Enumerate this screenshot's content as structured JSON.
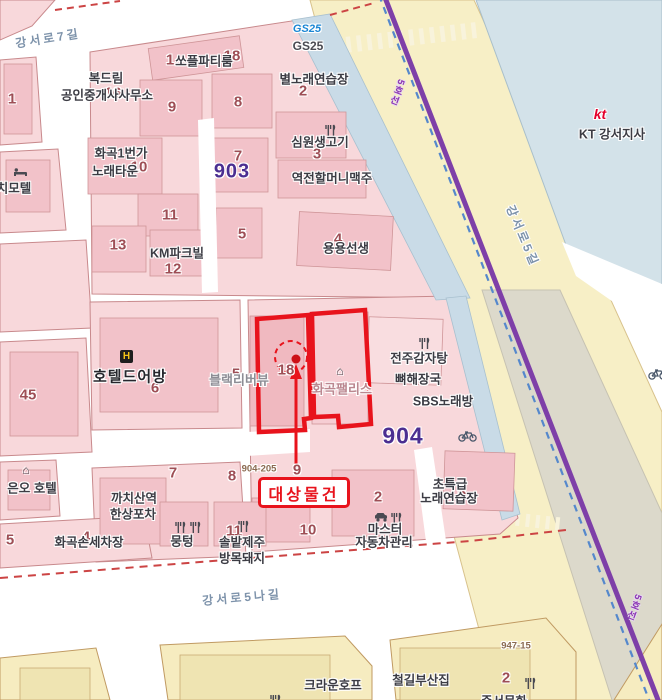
{
  "target": {
    "label": "대상물건",
    "number": "18"
  },
  "colors": {
    "target_red": "#e8131c",
    "red_dash": "#cc4444",
    "subway_purple": "#7e3fa8",
    "rail_blue_dash": "#5588cc",
    "district_purple": "#4b2e91",
    "block_pink": "#f8d8db",
    "building_pink": "#f2c2c9",
    "road_yellow": "#f7efc6",
    "kt_block_blue": "#d3e2e9",
    "sidewalk_blue": "#c9dbe7",
    "median_gray": "#dcd9cb",
    "bottom_block_yellow": "#f6ecc0"
  },
  "streets": [
    {
      "name": "street-gangseoro-7gil",
      "text": "강서로7길",
      "x": 48,
      "y": 38,
      "rot": -9
    },
    {
      "name": "street-gangseoro-5nagil",
      "text": "강서로5나길",
      "x": 242,
      "y": 597,
      "rot": -5
    },
    {
      "name": "street-gangseoro-5gil",
      "text": "강서로5길",
      "x": 523,
      "y": 236,
      "rot": 67
    }
  ],
  "subway_labels": [
    {
      "name": "subway-line5-label",
      "text": "5호선",
      "x": 396,
      "y": 92,
      "rot": 21
    },
    {
      "name": "subway-line5-label",
      "text": "5호선",
      "x": 633,
      "y": 607,
      "rot": 21
    }
  ],
  "district_numbers": [
    {
      "name": "block-number-903",
      "text": "903",
      "x": 232,
      "y": 172,
      "size": 20
    },
    {
      "name": "block-number-904",
      "text": "904",
      "x": 403,
      "y": 436,
      "size": 23
    }
  ],
  "building_numbers": [
    {
      "text": "1",
      "x": 12,
      "y": 99
    },
    {
      "text": "16",
      "x": 113,
      "y": 93
    },
    {
      "text": "1",
      "x": 170,
      "y": 60
    },
    {
      "text": "18",
      "x": 232,
      "y": 56
    },
    {
      "text": "9",
      "x": 172,
      "y": 107
    },
    {
      "text": "8",
      "x": 238,
      "y": 102
    },
    {
      "text": "2",
      "x": 303,
      "y": 91
    },
    {
      "text": "3",
      "x": 317,
      "y": 154
    },
    {
      "text": "7",
      "x": 238,
      "y": 156
    },
    {
      "text": "10",
      "x": 139,
      "y": 167
    },
    {
      "text": "11",
      "x": 170,
      "y": 215
    },
    {
      "text": "13",
      "x": 118,
      "y": 245
    },
    {
      "text": "12",
      "x": 173,
      "y": 269
    },
    {
      "text": "5",
      "x": 242,
      "y": 234
    },
    {
      "text": "4",
      "x": 338,
      "y": 239
    },
    {
      "text": "45",
      "x": 28,
      "y": 395
    },
    {
      "text": "6",
      "x": 155,
      "y": 388
    },
    {
      "text": "5",
      "x": 236,
      "y": 374
    },
    {
      "text": "18",
      "x": 286,
      "y": 370
    },
    {
      "text": "7",
      "x": 173,
      "y": 473
    },
    {
      "text": "8",
      "x": 232,
      "y": 476
    },
    {
      "text": "9",
      "x": 297,
      "y": 470
    },
    {
      "text": "10",
      "x": 308,
      "y": 530
    },
    {
      "text": "2",
      "x": 378,
      "y": 497
    },
    {
      "text": "6",
      "x": 462,
      "y": 493
    },
    {
      "text": "11",
      "x": 234,
      "y": 531
    },
    {
      "text": "2",
      "x": 506,
      "y": 678
    },
    {
      "text": "5",
      "x": 10,
      "y": 540
    },
    {
      "text": "4",
      "x": 86,
      "y": 537
    }
  ],
  "labels": [
    {
      "name": "label-bokdream",
      "text": "복드림",
      "x": 106,
      "y": 77,
      "cls": "lbl"
    },
    {
      "name": "label-realty-office",
      "text": "공인중개사사무소",
      "x": 107,
      "y": 94,
      "cls": "lbl"
    },
    {
      "name": "label-soplparty",
      "text": "쏘플파티룸",
      "x": 204,
      "y": 60,
      "cls": "lbl"
    },
    {
      "name": "label-byeol-karaoke",
      "text": "별노래연습장",
      "x": 314,
      "y": 78,
      "cls": "lbl"
    },
    {
      "name": "label-gs25-logo",
      "text": "GS25",
      "x": 307,
      "y": 29,
      "cls": "gs-logo"
    },
    {
      "name": "label-gs25",
      "text": "GS25",
      "x": 308,
      "y": 46,
      "cls": "gs-sub"
    },
    {
      "name": "label-simwon-meat",
      "text": "심원생고기",
      "x": 320,
      "y": 141,
      "cls": "lbl"
    },
    {
      "name": "label-yeokjeon-beer",
      "text": "역전할머니맥주",
      "x": 332,
      "y": 177,
      "cls": "lbl"
    },
    {
      "name": "label-hwagok1beonga",
      "text": "화곡1번가",
      "x": 121,
      "y": 152,
      "cls": "lbl"
    },
    {
      "name": "label-noraetown",
      "text": "노래타운",
      "x": 115,
      "y": 170,
      "cls": "lbl"
    },
    {
      "name": "label-km-parkville",
      "text": "KM파크빌",
      "x": 177,
      "y": 252,
      "cls": "lbl"
    },
    {
      "name": "label-yongyong",
      "text": "용용선생",
      "x": 346,
      "y": 247,
      "cls": "lbl"
    },
    {
      "name": "label-motel",
      "text": "치모텔",
      "x": 14,
      "y": 187,
      "cls": "lbl"
    },
    {
      "name": "label-hotel-deoban",
      "text": "호텔드어방",
      "x": 130,
      "y": 376,
      "cls": "lbl-lg"
    },
    {
      "name": "label-black-riverview",
      "text": "블랙리버뷰",
      "x": 239,
      "y": 379,
      "cls": "lbl-gray"
    },
    {
      "name": "label-hwagok-palace",
      "text": "화곡팰리스",
      "x": 342,
      "y": 388,
      "cls": "lbl-pink"
    },
    {
      "name": "label-jeonju-gamjatang",
      "text": "전주감자탕",
      "x": 419,
      "y": 357,
      "cls": "lbl"
    },
    {
      "name": "label-ppyeohaejangguk",
      "text": "뼈해장국",
      "x": 418,
      "y": 378,
      "cls": "lbl"
    },
    {
      "name": "label-sbs-karaoke",
      "text": "SBS노래방",
      "x": 443,
      "y": 400,
      "cls": "lbl"
    },
    {
      "name": "label-chotteukgeup",
      "text": "초특급",
      "x": 450,
      "y": 483,
      "cls": "lbl"
    },
    {
      "name": "label-karaoke-practice",
      "text": "노래연습장",
      "x": 449,
      "y": 497,
      "cls": "lbl"
    },
    {
      "name": "label-master",
      "text": "마스터",
      "x": 385,
      "y": 528,
      "cls": "lbl"
    },
    {
      "name": "label-car-care",
      "text": "자동차관리",
      "x": 384,
      "y": 541,
      "cls": "lbl"
    },
    {
      "name": "label-kkachisan-station",
      "text": "까치산역",
      "x": 134,
      "y": 497,
      "cls": "lbl"
    },
    {
      "name": "label-hansang-pocha",
      "text": "한상포차",
      "x": 133,
      "y": 513,
      "cls": "lbl"
    },
    {
      "name": "label-carwash",
      "text": "화곡손세차장",
      "x": 89,
      "y": 541,
      "cls": "lbl"
    },
    {
      "name": "label-euno-hotel",
      "text": "은오 호텔",
      "x": 32,
      "y": 487,
      "cls": "lbl"
    },
    {
      "name": "label-mungteong",
      "text": "뭉텅",
      "x": 182,
      "y": 540,
      "cls": "lbl"
    },
    {
      "name": "label-solbat-jeju",
      "text": "솔밭제주",
      "x": 242,
      "y": 541,
      "cls": "lbl"
    },
    {
      "name": "label-bangmok-pig",
      "text": "방목돼지",
      "x": 242,
      "y": 557,
      "cls": "lbl"
    },
    {
      "name": "label-crown-hof",
      "text": "크라운호프",
      "x": 333,
      "y": 684,
      "cls": "lbl"
    },
    {
      "name": "label-cheolgil-busan",
      "text": "철길부산집",
      "x": 421,
      "y": 679,
      "cls": "lbl"
    },
    {
      "name": "label-junseo",
      "text": "준서문화",
      "x": 504,
      "y": 700,
      "cls": "lbl"
    },
    {
      "name": "label-kt-logo",
      "text": "kt",
      "x": 600,
      "y": 114,
      "cls": "kt-logo"
    },
    {
      "name": "label-kt-gangseo",
      "text": "KT 강서지사",
      "x": 612,
      "y": 133,
      "cls": "lbl"
    }
  ],
  "small_parcels": [
    {
      "name": "parcel-904-205",
      "text": "904-205",
      "x": 259,
      "y": 469
    },
    {
      "name": "parcel-947-15",
      "text": "947-15",
      "x": 516,
      "y": 646
    }
  ],
  "icons": [
    {
      "name": "utensils-icon",
      "type": "utensils",
      "x": 323,
      "y": 124
    },
    {
      "name": "utensils-icon",
      "type": "utensils",
      "x": 417,
      "y": 337
    },
    {
      "name": "utensils-icon",
      "type": "utensils",
      "x": 173,
      "y": 521
    },
    {
      "name": "utensils-icon",
      "type": "utensils",
      "x": 188,
      "y": 521
    },
    {
      "name": "utensils-icon",
      "type": "utensils",
      "x": 236,
      "y": 520
    },
    {
      "name": "utensils-icon",
      "type": "utensils",
      "x": 268,
      "y": 694
    },
    {
      "name": "utensils-icon",
      "type": "utensils",
      "x": 523,
      "y": 677
    },
    {
      "name": "utensils-icon",
      "type": "utensils",
      "x": 389,
      "y": 512
    },
    {
      "name": "car-icon",
      "type": "car",
      "x": 374,
      "y": 512
    },
    {
      "name": "bicycle-icon",
      "type": "bike",
      "x": 458,
      "y": 430
    },
    {
      "name": "bicycle-icon",
      "type": "bike",
      "x": 648,
      "y": 368
    },
    {
      "name": "building-icon",
      "type": "house",
      "x": 26,
      "y": 470
    },
    {
      "name": "building-icon",
      "type": "house",
      "x": 340,
      "y": 371
    },
    {
      "name": "motel-icon",
      "type": "bed",
      "x": 13,
      "y": 167
    }
  ]
}
